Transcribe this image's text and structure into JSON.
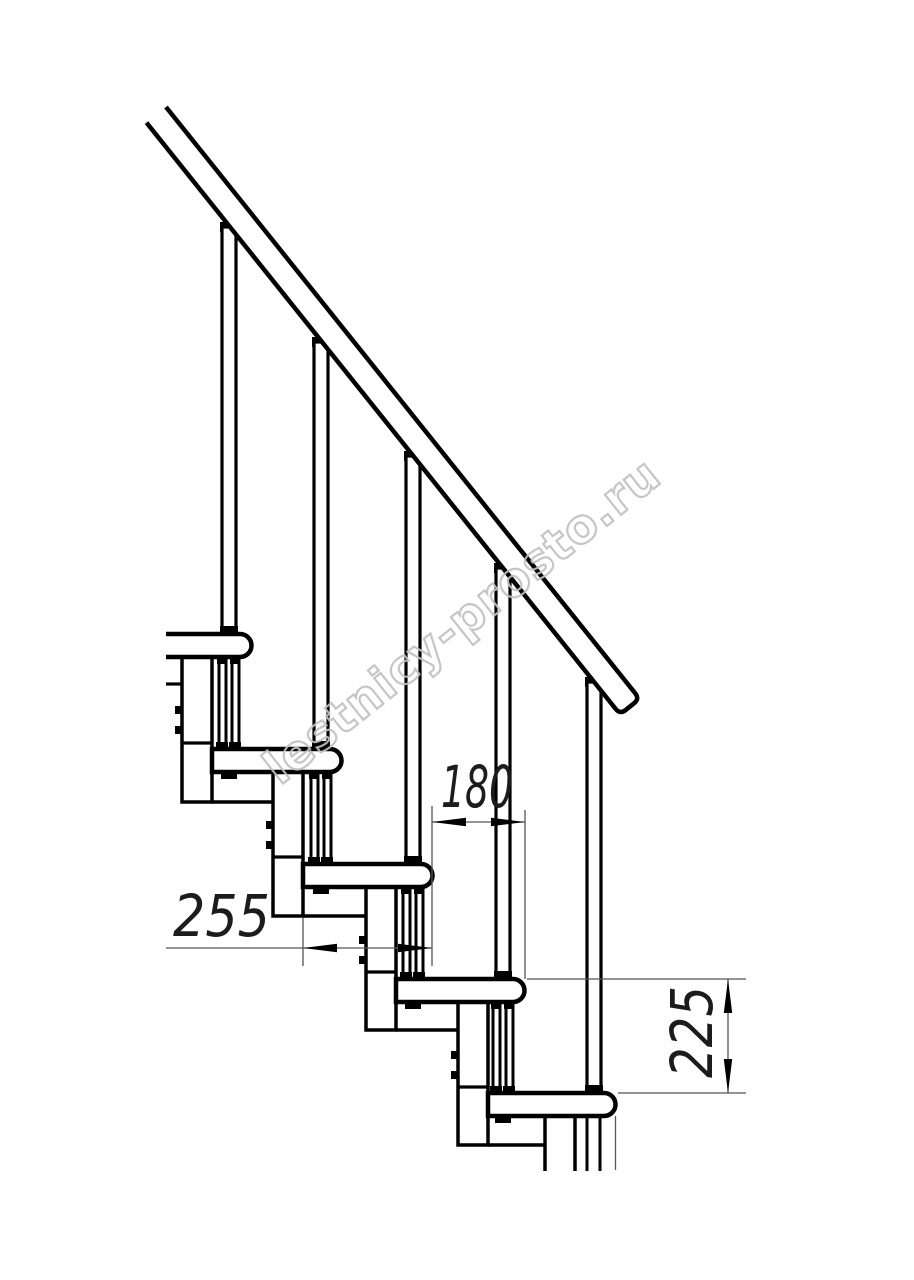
{
  "drawing": {
    "kind": "modular-staircase-side-view",
    "dimensions": {
      "tread_depth": {
        "label": "255"
      },
      "step_run": {
        "label": "180"
      },
      "step_rise": {
        "label": "225"
      }
    },
    "watermark": {
      "text": "lestnicy-prosto.ru"
    }
  },
  "colors": {
    "ink": "#000000",
    "dimension": "#555555",
    "watermark": "#c0c0c0",
    "background": "#ffffff"
  }
}
